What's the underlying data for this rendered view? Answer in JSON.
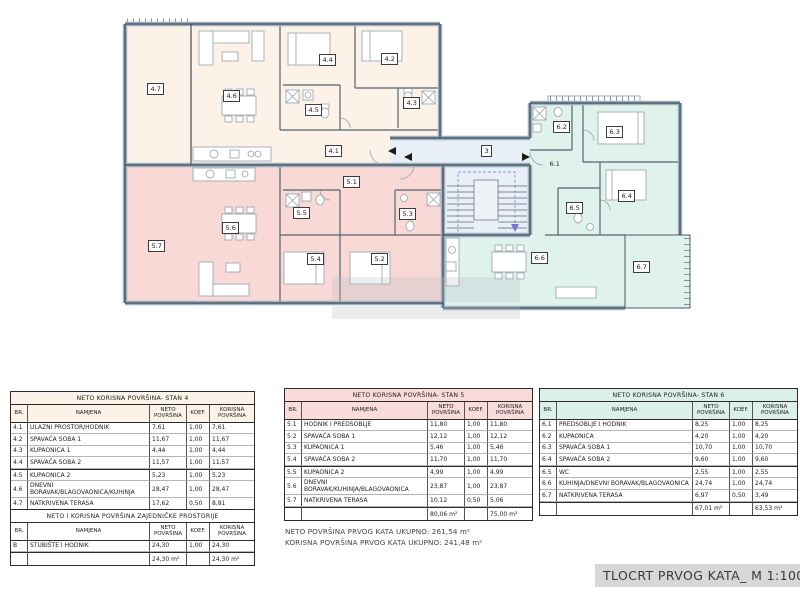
{
  "plan": {
    "colors": {
      "stan4": "#fdf2e7",
      "stan5": "#f9d9d5",
      "stan6": "#e0f2ec",
      "common": "#e9eff7",
      "wall": "#3c4a57"
    },
    "labels": [
      {
        "id": "3",
        "x": 490,
        "y": 151
      },
      {
        "id": "4.1",
        "x": 334,
        "y": 151
      },
      {
        "id": "4.2",
        "x": 390,
        "y": 59
      },
      {
        "id": "4.3",
        "x": 412,
        "y": 103
      },
      {
        "id": "4.4",
        "x": 328,
        "y": 60
      },
      {
        "id": "4.5",
        "x": 314,
        "y": 110
      },
      {
        "id": "4.6",
        "x": 232,
        "y": 96
      },
      {
        "id": "4.7",
        "x": 156,
        "y": 89
      },
      {
        "id": "5.1",
        "x": 352,
        "y": 182
      },
      {
        "id": "5.2",
        "x": 380,
        "y": 259
      },
      {
        "id": "5.3",
        "x": 408,
        "y": 214
      },
      {
        "id": "5.4",
        "x": 316,
        "y": 259
      },
      {
        "id": "5.5",
        "x": 302,
        "y": 213
      },
      {
        "id": "5.6",
        "x": 231,
        "y": 228
      },
      {
        "id": "5.7",
        "x": 157,
        "y": 246
      },
      {
        "id": "6.1",
        "x": 556,
        "y": 165,
        "box": false
      },
      {
        "id": "6.2",
        "x": 562,
        "y": 127
      },
      {
        "id": "6.3",
        "x": 615,
        "y": 132
      },
      {
        "id": "6.4",
        "x": 627,
        "y": 196
      },
      {
        "id": "6.5",
        "x": 575,
        "y": 208
      },
      {
        "id": "6.6",
        "x": 540,
        "y": 258
      },
      {
        "id": "6.7",
        "x": 642,
        "y": 267
      }
    ]
  },
  "tables": [
    {
      "title": "NETO KORISNA POVRŠINA- STAN 4",
      "header_bg": "#fdf2e7",
      "columns": [
        "BR.",
        "NAMJENA",
        "NETO POVRŠINA",
        "KOEF.",
        "KORISNA POVRŠINA"
      ],
      "rows": [
        [
          "4.1",
          "ULAZNI PROSTOR/HODNIK",
          "7,61",
          "1,00",
          "7,61"
        ],
        [
          "4.2",
          "SPAVAĆA SOBA 1",
          "11,67",
          "1,00",
          "11,67"
        ],
        [
          "4.3",
          "KUPAONICA 1",
          "4,44",
          "1,00",
          "4,44"
        ],
        [
          "4.4",
          "SPAVAĆA SOBA 2",
          "11,57",
          "1,00",
          "11,57"
        ],
        [
          "4.5",
          "KUPAONICA 2",
          "5,23",
          "1,00",
          "5,23"
        ],
        [
          "4.6",
          "DNEVNI BORAVAK/BLAGOVAONICA/KUHINJA",
          "28,47",
          "1,00",
          "28,47"
        ],
        [
          "4.7",
          "NATKRIVENA TERASA",
          "17,62",
          "0,50",
          "8,81"
        ]
      ],
      "total_neto": "86,61 m²",
      "total_korisna": "77,80 m²"
    },
    {
      "title": "NETO KORISNA POVRŠINA- STAN 5",
      "header_bg": "#f9dcda",
      "columns": [
        "BR.",
        "NAMJENA",
        "NETO POVRŠINA",
        "KOEF.",
        "KORISNA POVRŠINA"
      ],
      "rows": [
        [
          "5.1",
          "HODNIK I PREDSOBLJE",
          "11,80",
          "1,00",
          "11,80"
        ],
        [
          "5.2",
          "SPAVAĆA SOBA 1",
          "12,12",
          "1,00",
          "12,12"
        ],
        [
          "5.3",
          "KUPAONICA 1",
          "5,46",
          "1,00",
          "5,46"
        ],
        [
          "5.4",
          "SPAVAĆA SOBA 2",
          "11,70",
          "1,00",
          "11,70"
        ],
        [
          "5.5",
          "KUPAONICA 2",
          "4,99",
          "1,00",
          "4,99"
        ],
        [
          "5.6",
          "DNEVNI BORAVAK/KUHINJA/BLAGOVAONICA",
          "23,87",
          "1,00",
          "23,87"
        ],
        [
          "5.7",
          "NATKRIVENA TERASA",
          "10,12",
          "0,50",
          "5,06"
        ]
      ],
      "total_neto": "80,06 m²",
      "total_korisna": "75,00 m²"
    },
    {
      "title": "NETO KORISNA POVRŠINA- STAN 6",
      "header_bg": "#dcf0ea",
      "columns": [
        "BR.",
        "NAMJENA",
        "NETO POVRŠINA",
        "KOEF.",
        "KORISNA POVRŠINA"
      ],
      "rows": [
        [
          "6.1",
          "PREDSOBLJE I HODNIK",
          "8,25",
          "1,00",
          "8,25"
        ],
        [
          "6.2",
          "KUPAONICA",
          "4,20",
          "1,00",
          "4,20"
        ],
        [
          "6.3",
          "SPAVAĆA SOBA 1",
          "10,70",
          "1,00",
          "10,70"
        ],
        [
          "6.4",
          "SPAVAĆA SOBA 2",
          "9,60",
          "1,00",
          "9,60"
        ],
        [
          "6.5",
          "WC",
          "2,55",
          "1,00",
          "2,55"
        ],
        [
          "6.6",
          "KUHINJA/DNEVNI BORAVAK/BLAGOVAONICA",
          "24,74",
          "1,00",
          "24,74"
        ],
        [
          "6.7",
          "NATKRIVENA TERASA",
          "6,97",
          "0,50",
          "3,49"
        ]
      ],
      "total_neto": "67,01 m²",
      "total_korisna": "63,53 m²"
    },
    {
      "title": "NETO I KORISNA POVRŠINA ZAJEDNIČKE PROSTORIJE",
      "header_bg": "#ffffff",
      "columns": [
        "BR.",
        "NAMJENA",
        "NETO POVRŠINA",
        "KOEF.",
        "KORISNA POVRŠINA"
      ],
      "rows": [
        [
          "B",
          "STUBIŠTE I HODNIK",
          "24,30",
          "1,00",
          "24,30"
        ]
      ],
      "total_neto": "24,30 m²",
      "total_korisna": "24,30 m²"
    }
  ],
  "summary": {
    "line1": "NETO POVRŠINA PRVOG KATA UKUPNO: 261,54 m²",
    "line2": "KORISNA POVRŠINA PRVOG KATA UKUPNO: 241,48 m²"
  },
  "title_block": {
    "label": "TLOCRT PRVOG KATA_ M 1:100"
  }
}
